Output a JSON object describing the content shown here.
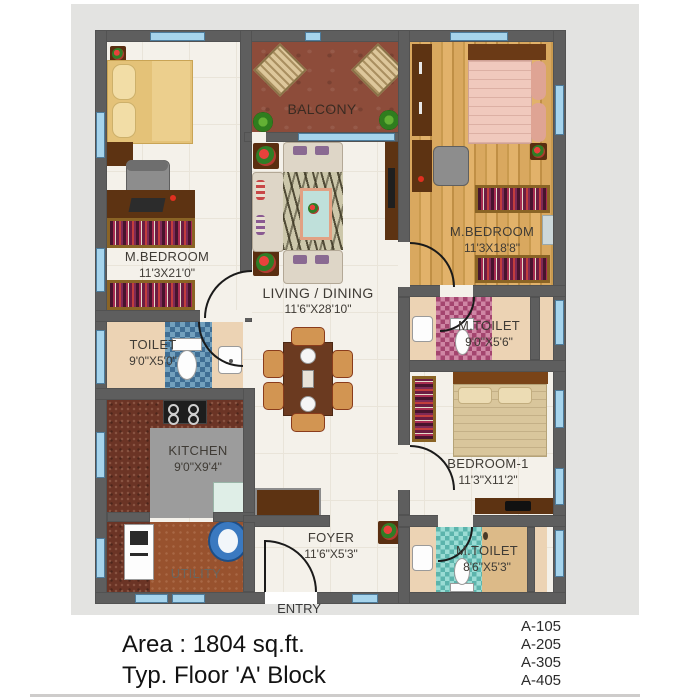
{
  "plan": {
    "rooms": [
      {
        "id": "m_bedroom_left",
        "name": "M.BEDROOM",
        "dims": "11'3X21'0\""
      },
      {
        "id": "balcony",
        "name": "BALCONY",
        "dims": ""
      },
      {
        "id": "m_bedroom_right",
        "name": "M.BEDROOM",
        "dims": "11'3X18'8\""
      },
      {
        "id": "living_dining",
        "name": "LIVING / DINING",
        "dims": "11'6\"X28'10\""
      },
      {
        "id": "toilet",
        "name": "TOILET",
        "dims": "9'0\"X5'0\""
      },
      {
        "id": "m_toilet_mid",
        "name": "M.TOILET",
        "dims": "9'0\"X5'6\""
      },
      {
        "id": "kitchen",
        "name": "KITCHEN",
        "dims": "9'0\"X9'4\""
      },
      {
        "id": "bedroom_1",
        "name": "BEDROOM-1",
        "dims": "11'3\"X11'2\""
      },
      {
        "id": "utility",
        "name": "UTILITY",
        "dims": ""
      },
      {
        "id": "foyer",
        "name": "FOYER",
        "dims": "11'6\"X5'3\""
      },
      {
        "id": "m_toilet_bottom",
        "name": "M.TOILET",
        "dims": "8'6\"X5'3\""
      }
    ],
    "entry_label": "ENTRY"
  },
  "title_block": {
    "area": "Area : 1804 sq.ft.",
    "floor": "Typ. Floor 'A' Block",
    "units": [
      "A-105",
      "A-205",
      "A-305",
      "A-405"
    ]
  },
  "colors": {
    "background_panel": "#e3e3e1",
    "wall": "#5e5e5e",
    "window_glass": "#a6d4ec",
    "balcony_floor": "#8d4c3a",
    "wood_floor": "#d9a85f",
    "blue_mosaic": "#3f6e94",
    "pink_mosaic": "#a4456f",
    "teal_mosaic": "#5cb4ac",
    "kitchen_counter": "#6b3425",
    "utility_floor": "#98522e",
    "dark_furniture": "#5d3312",
    "bed_tan": "#e4c278",
    "bed_pink": "#f0c9bd"
  }
}
